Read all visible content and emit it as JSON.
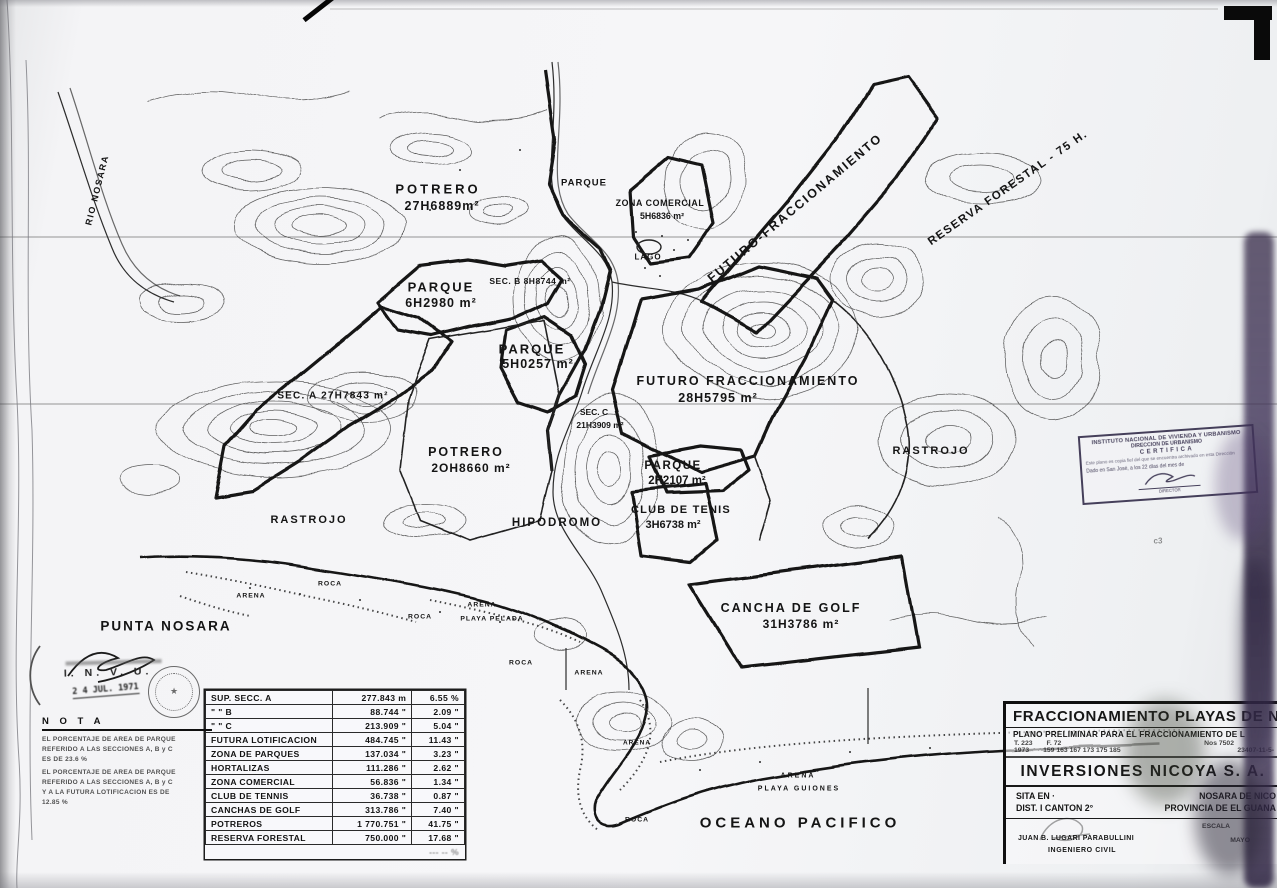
{
  "map": {
    "labels": {
      "rio_nosara": "RIO NOSARA",
      "potrero1_name": "POTRERO",
      "potrero1_area": "27H6889m²",
      "parque_top": "PARQUE",
      "zona_comercial_name": "ZONA COMERCIAL",
      "zona_comercial_area": "5H6836 m²",
      "lago": "LAGO",
      "futuro_fraccionamiento_diagonal": "FUTURO-FRACCIONAMIENTO",
      "reserva_forestal": "RESERVA FORESTAL - 75 H.",
      "parque6_name": "PARQUE",
      "parque6_area": "6H2980 m²",
      "sec_b": "SEC. B 8H8744 m²",
      "parque5_name": "PARQUE",
      "parque5_area": "5H0257 m²",
      "sec_a": "SEC. A 27H7843 m²",
      "futuro28_name": "FUTURO FRACCIONAMIENTO",
      "futuro28_area": "28H5795 m²",
      "sec_c_name": "SEC. C",
      "sec_c_area": "21H3909 m²",
      "potrero20_name": "POTRERO",
      "potrero20_area": "2OH8660 m²",
      "rastrojo_right": "RASTROJO",
      "parque2_name": "PARQUE",
      "parque2_area": "2H2107 m²",
      "club_tenis_name": "CLUB DE TENIS",
      "club_tenis_area": "3H6738 m²",
      "hipodromo": "HIPODROMO",
      "rastrojo_left": "RASTROJO",
      "punta_nosara": "PUNTA NOSARA",
      "cancha_golf_name": "CANCHA DE GOLF",
      "cancha_golf_area": "31H3786 m²",
      "oceano_pacifico": "OCEANO PACIFICO",
      "playa_guiones": "PLAYA GUIONES",
      "playa_pelada": "PLAYA  PELADA",
      "arena_1": "ARENA",
      "arena_2": "ARENA",
      "arena_3": "ARENA",
      "arena_4": "ARENA",
      "arena_5": "ARENA",
      "roca_1": "ROCA",
      "roca_2": "ROCA",
      "roca_3": "ROCA",
      "roca_4": "ROCA",
      "mark_c3": "c3"
    }
  },
  "areas_table": {
    "rows": [
      {
        "label": "SUP. SECC.  A",
        "area": "277.843 m",
        "pct": "6.55 %"
      },
      {
        "label": "\"        \"        B",
        "area": "88.744 \"",
        "pct": "2.09 \""
      },
      {
        "label": "\"        \"        C",
        "area": "213.909 \"",
        "pct": "5.04 \""
      },
      {
        "label": "FUTURA LOTIFICACION",
        "area": "484.745 \"",
        "pct": "11.43 \""
      },
      {
        "label": "ZONA DE PARQUES",
        "area": "137.034 \"",
        "pct": "3.23 \""
      },
      {
        "label": "HORTALIZAS",
        "area": "111.286 \"",
        "pct": "2.62 \""
      },
      {
        "label": "ZONA COMERCIAL",
        "area": "56.836 \"",
        "pct": "1.34 \""
      },
      {
        "label": "CLUB DE TENNIS",
        "area": "36.738 \"",
        "pct": "0.87 \""
      },
      {
        "label": "CANCHAS DE GOLF",
        "area": "313.786 \"",
        "pct": "7.40 \""
      },
      {
        "label": "POTREROS",
        "area": "1 770.751 \"",
        "pct": "41.75 \""
      },
      {
        "label": "RESERVA FORESTAL",
        "area": "750.000 \"",
        "pct": "17.68 \""
      },
      {
        "label": "",
        "area": "",
        "pct": "--- -- %"
      }
    ]
  },
  "nota": {
    "title": "N O T A",
    "lines": [
      "EL PORCENTAJE DE AREA DE PARQUE",
      "REFERIDO A LAS SECCIONES A, B y C",
      "ES DE 23.6 %",
      "EL PORCENTAJE DE AREA DE PARQUE",
      "REFERIDO A LAS SECCIONES A, B y C",
      "Y A LA FUTURA LOTIFICACION ES DE",
      "12.85 %"
    ]
  },
  "invu_stamp": {
    "name": "I. N. V. U.",
    "date": "2 4  JUL. 1971"
  },
  "cert_stamp": {
    "line1": "INSTITUTO NACIONAL DE VIVIENDA Y URBANISMO",
    "line2": "DIRECCION DE URBANISMO",
    "line3": "CERTIFICA",
    "line4": "Este plano es copia fiel del que se encuentra archivado en esta Dirección",
    "line6": "Dado en San José, a los 22 días del mes de",
    "line7": "DIRECTOR"
  },
  "title_block": {
    "project": "FRACCIONAMIENTO PLAYAS DE NOSA",
    "subtitle": "PLANO PRELIMINAR PARA EL FRACCIONAMIENTO DE L",
    "ref_t": "T. 223",
    "ref_f": "F. 72",
    "ref_nos": "Nos 7502",
    "ref_year": "1973",
    "ref_sheets": "159 163 167 173 175 185",
    "ref_num": "23407-11-5-",
    "company": "INVERSIONES NICOYA S. A.",
    "sita_label": "SITA  EN ·",
    "sita_value": "NOSARA  DE  NICO",
    "dist_label": "DIST. I    CANTON 2°",
    "dist_value": "PROVINCIA DE EL GUANA",
    "engineer": "JUAN B. LUGARI PARABULLINI",
    "engineer_title": "INGENIERO CIVIL",
    "escala": "ESCALA",
    "mes": "MAYO"
  }
}
